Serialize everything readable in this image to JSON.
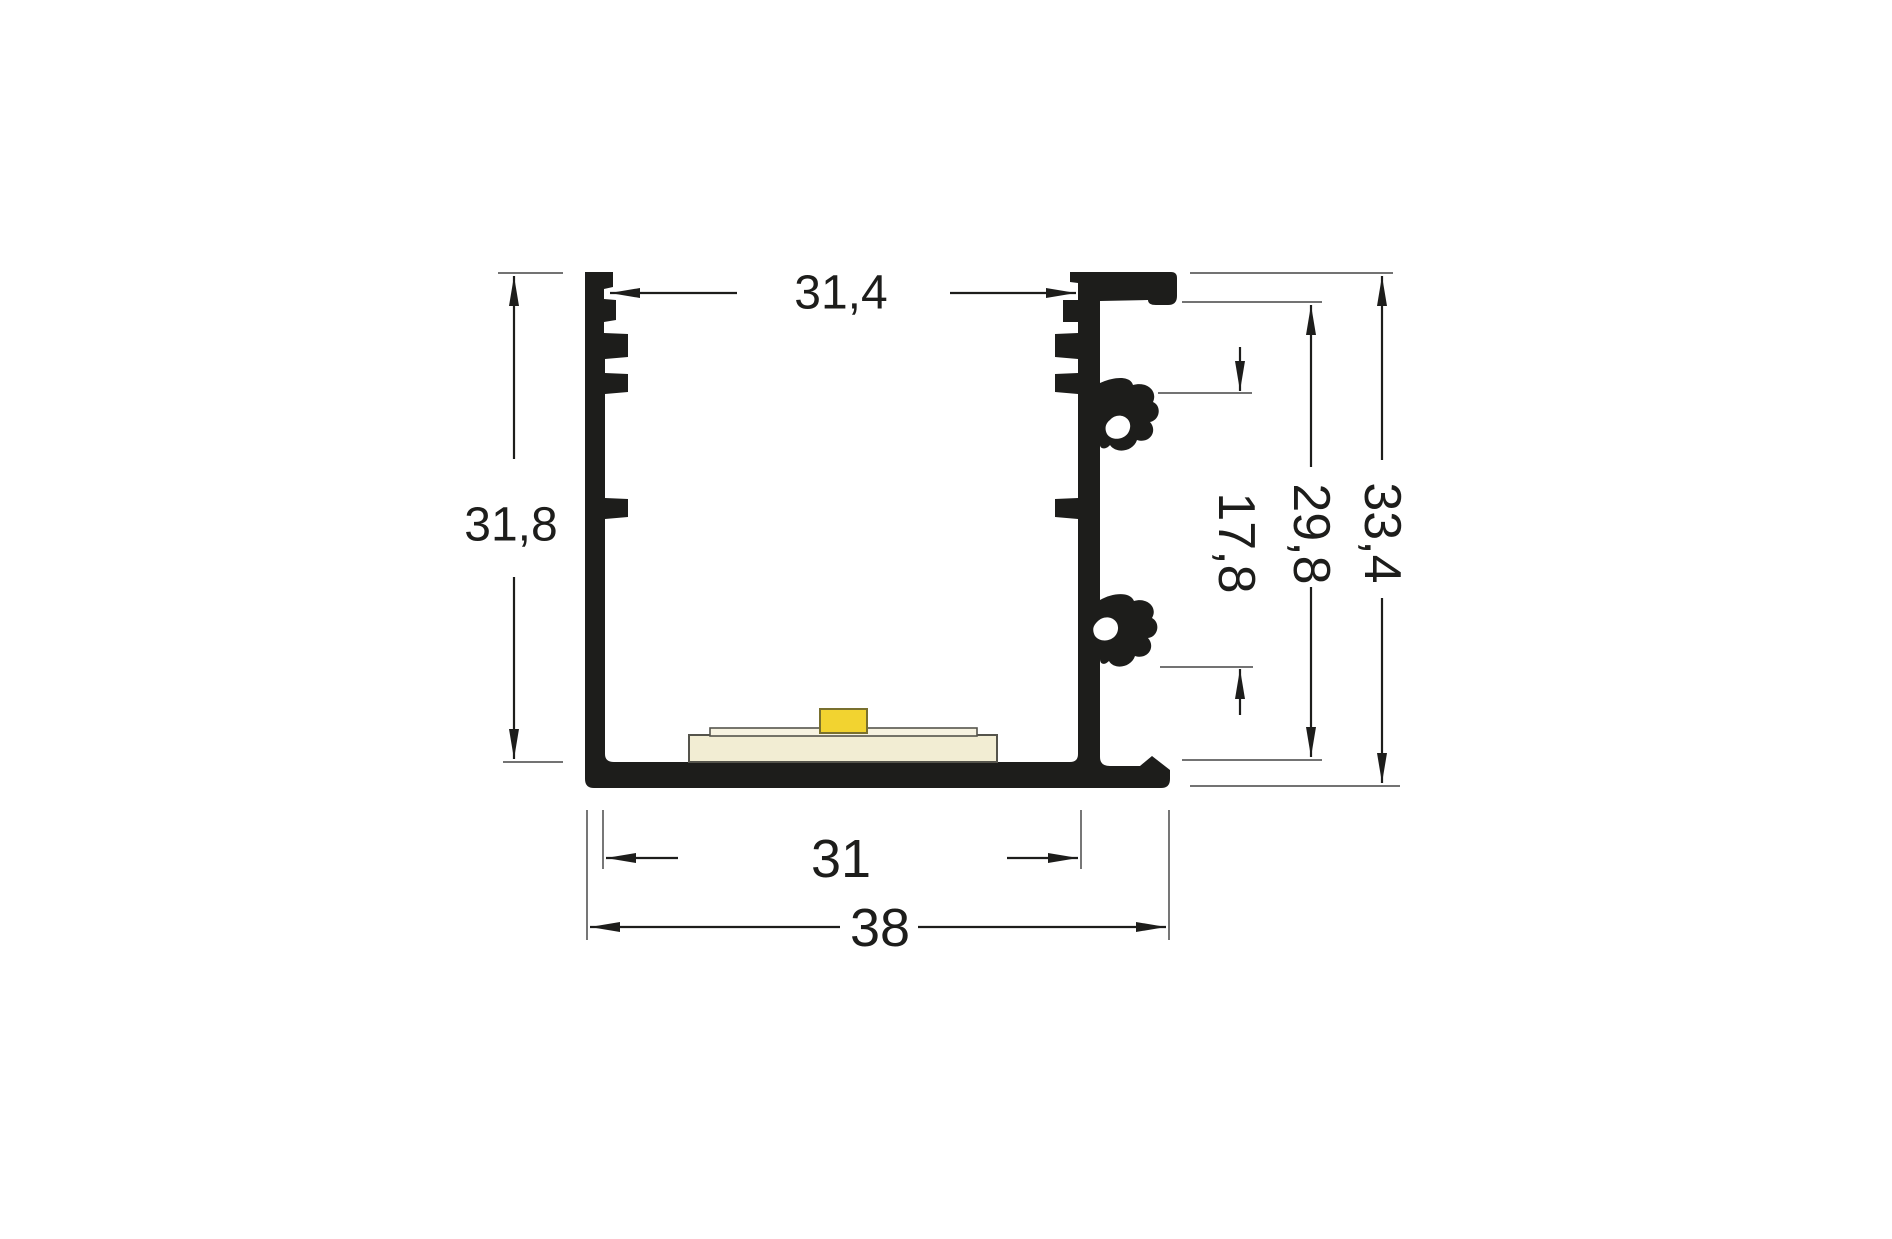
{
  "figure": {
    "type": "technical-cross-section",
    "subject": "LED aluminium profile cross-section with dimension annotations"
  },
  "dims": {
    "top_inner_width": "31,4",
    "left_outer_height": "31,8",
    "right_clip_span": "17,8",
    "right_inner_height": "29,8",
    "right_overall_height": "33,4",
    "bottom_inner_width": "31",
    "bottom_overall_width": "38"
  },
  "dim_values": {
    "top_inner_width": 31.4,
    "left_outer_height": 31.8,
    "right_clip_span": 17.8,
    "right_inner_height": 29.8,
    "right_overall_height": 33.4,
    "bottom_inner_width": 31,
    "bottom_overall_width": 38
  },
  "colors": {
    "profile": "#1d1d1b",
    "dimension_lines": "#1d1d1b",
    "extension_lines": "#5f5f5f",
    "led_chip_fill": "#f2d330",
    "led_chip_border": "#79702e",
    "pcb_fill": "#f2edd3",
    "pcb_top_fill": "#f7f3e1",
    "pcb_border": "#55544c",
    "background": "#ffffff"
  }
}
